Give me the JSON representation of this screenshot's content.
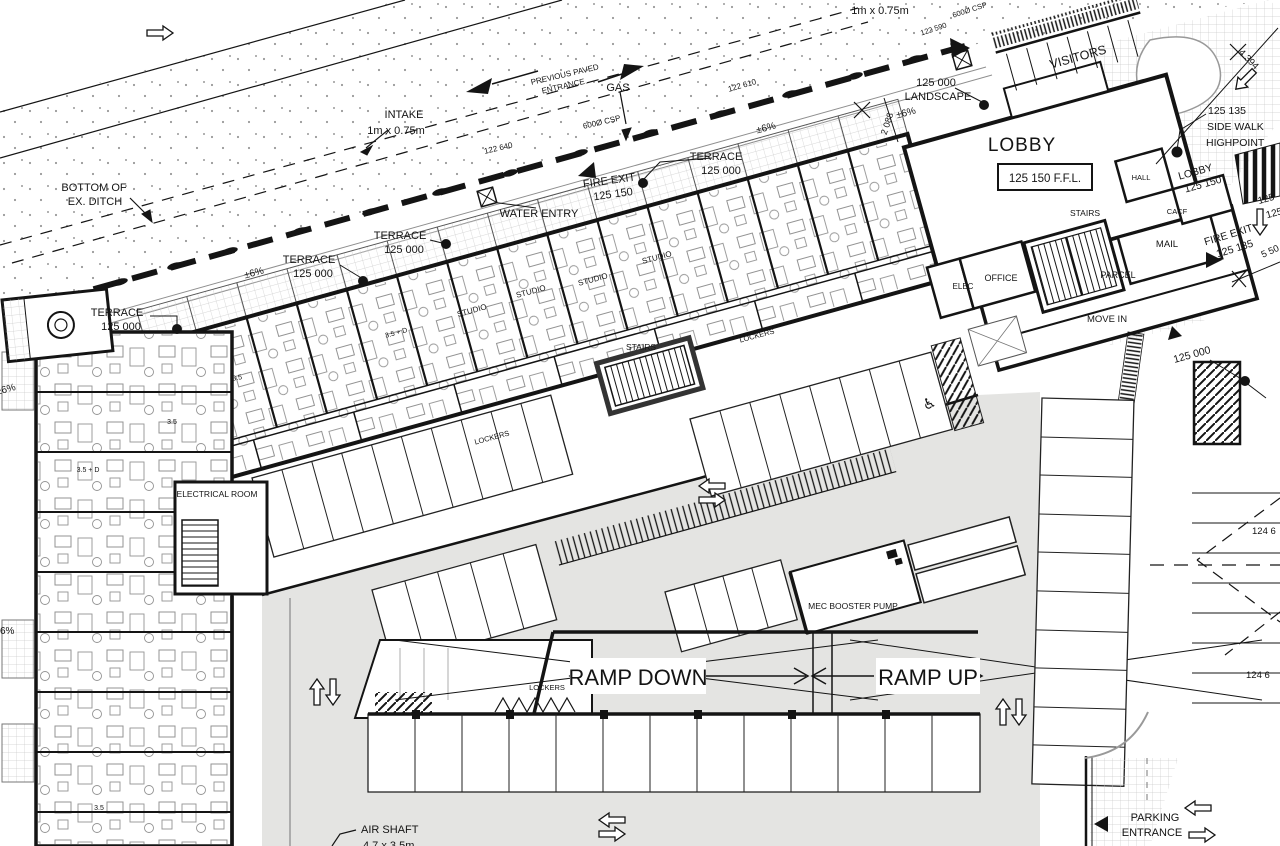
{
  "drawing": {
    "colors": {
      "paper": "#ffffff",
      "ink": "#141414",
      "drive_gray": "#e4e4e2",
      "line_gray": "#9a9a9a"
    }
  },
  "icons": {
    "accessible": "♿"
  },
  "labels": {
    "size_1m075": "1m x 0.75m",
    "intake": "INTAKE",
    "level_122_590": "122 590",
    "csp_600": "600Ø CSP",
    "visitors": "VISITORS",
    "landscape": "LANDSCAPE",
    "level_125000": "125 000",
    "dim_4394": "4 394",
    "level_125135": "125 135",
    "side_walk": "SIDE WALK",
    "highpoint": "HIGHPOINT",
    "lobby": "LOBBY",
    "ffl": "125 150 F.F.L.",
    "level_125150": "125 150",
    "fire_exit": "FIRE EXIT",
    "gas": "GAS",
    "previous_paved": "PREVIOUS PAVED",
    "entrance_period": "ENTRANCE.",
    "level_122_610": "122 610",
    "level_122_640": "122 640",
    "slope": "±6%",
    "slope_cut": "6%",
    "terrace": "TERRACE",
    "water_entry": "WATER ENTRY",
    "bottom_of": "BOTTOM OF",
    "ex_ditch": "EX. DITCH",
    "studio": "STUDIO",
    "stairs": "STAIRS",
    "lockers": "LOCKERS",
    "electrical_room": "ELECTRICAL ROOM",
    "office": "OFFICE",
    "elec": "ELEC",
    "mail": "MAIL",
    "parcel": "PARCEL",
    "move_in": "MOVE IN",
    "hall": "HALL",
    "cacf": "CACF",
    "mec_booster": "MEC BOOSTER PUMP",
    "ramp_down": "RAMP DOWN",
    "ramp_up": "RAMP UP",
    "air_shaft": "AIR SHAFT",
    "air_shaft_size": "4.7 x 3.5m",
    "parking": "PARKING",
    "entrance": "ENTRANCE",
    "level_124_250": "124 250",
    "dim_2088": "2 088",
    "dim_5_50": "5 50",
    "edge_125": "125",
    "edge_124_6": "124 6",
    "unit_3_5": "3.5",
    "unit_3_5_d": "3.5 + D"
  }
}
